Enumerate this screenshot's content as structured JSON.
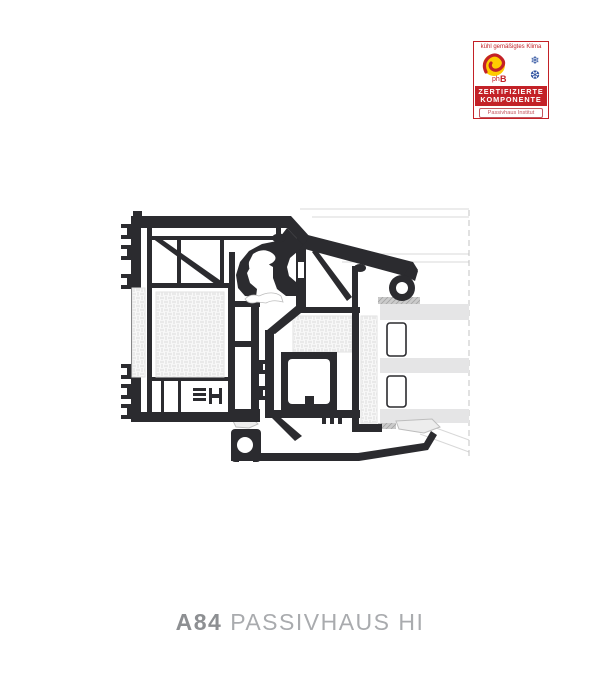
{
  "badge": {
    "climate_label": "kühl gemäßigtes Klima",
    "logo_ph": "ph",
    "logo_b": "B",
    "snowflake_top": "❄",
    "snowflake_bottom": "❆",
    "cert_line1": "ZERTIFIZIERTE",
    "cert_line2": "KOMPONENTE",
    "institute": "Passivhaus Institut"
  },
  "caption": {
    "code": "A84",
    "name": "PASSIVHAUS HI"
  },
  "figure": {
    "kind": "window-profile-cross-section",
    "glazing_panes": 3
  },
  "colors": {
    "badge_red": "#c32127",
    "badge_yellow": "#ffcc00",
    "badge_blue": "#2b4f9e",
    "institute_red": "#c4565e",
    "profile_dark": "#2b2b2f",
    "glass_gray": "#e5e5e6",
    "hatch_gray": "#dcdcdc",
    "sealant_gray": "#cbcbcb",
    "hairline_gray": "#d8d8d8",
    "cutline_gray": "#c3c3c3",
    "outline_gray": "#bdbdbd",
    "caption_code_gray": "#8d8f92",
    "caption_name_gray": "#a9abae",
    "page_bg": "#ffffff"
  }
}
